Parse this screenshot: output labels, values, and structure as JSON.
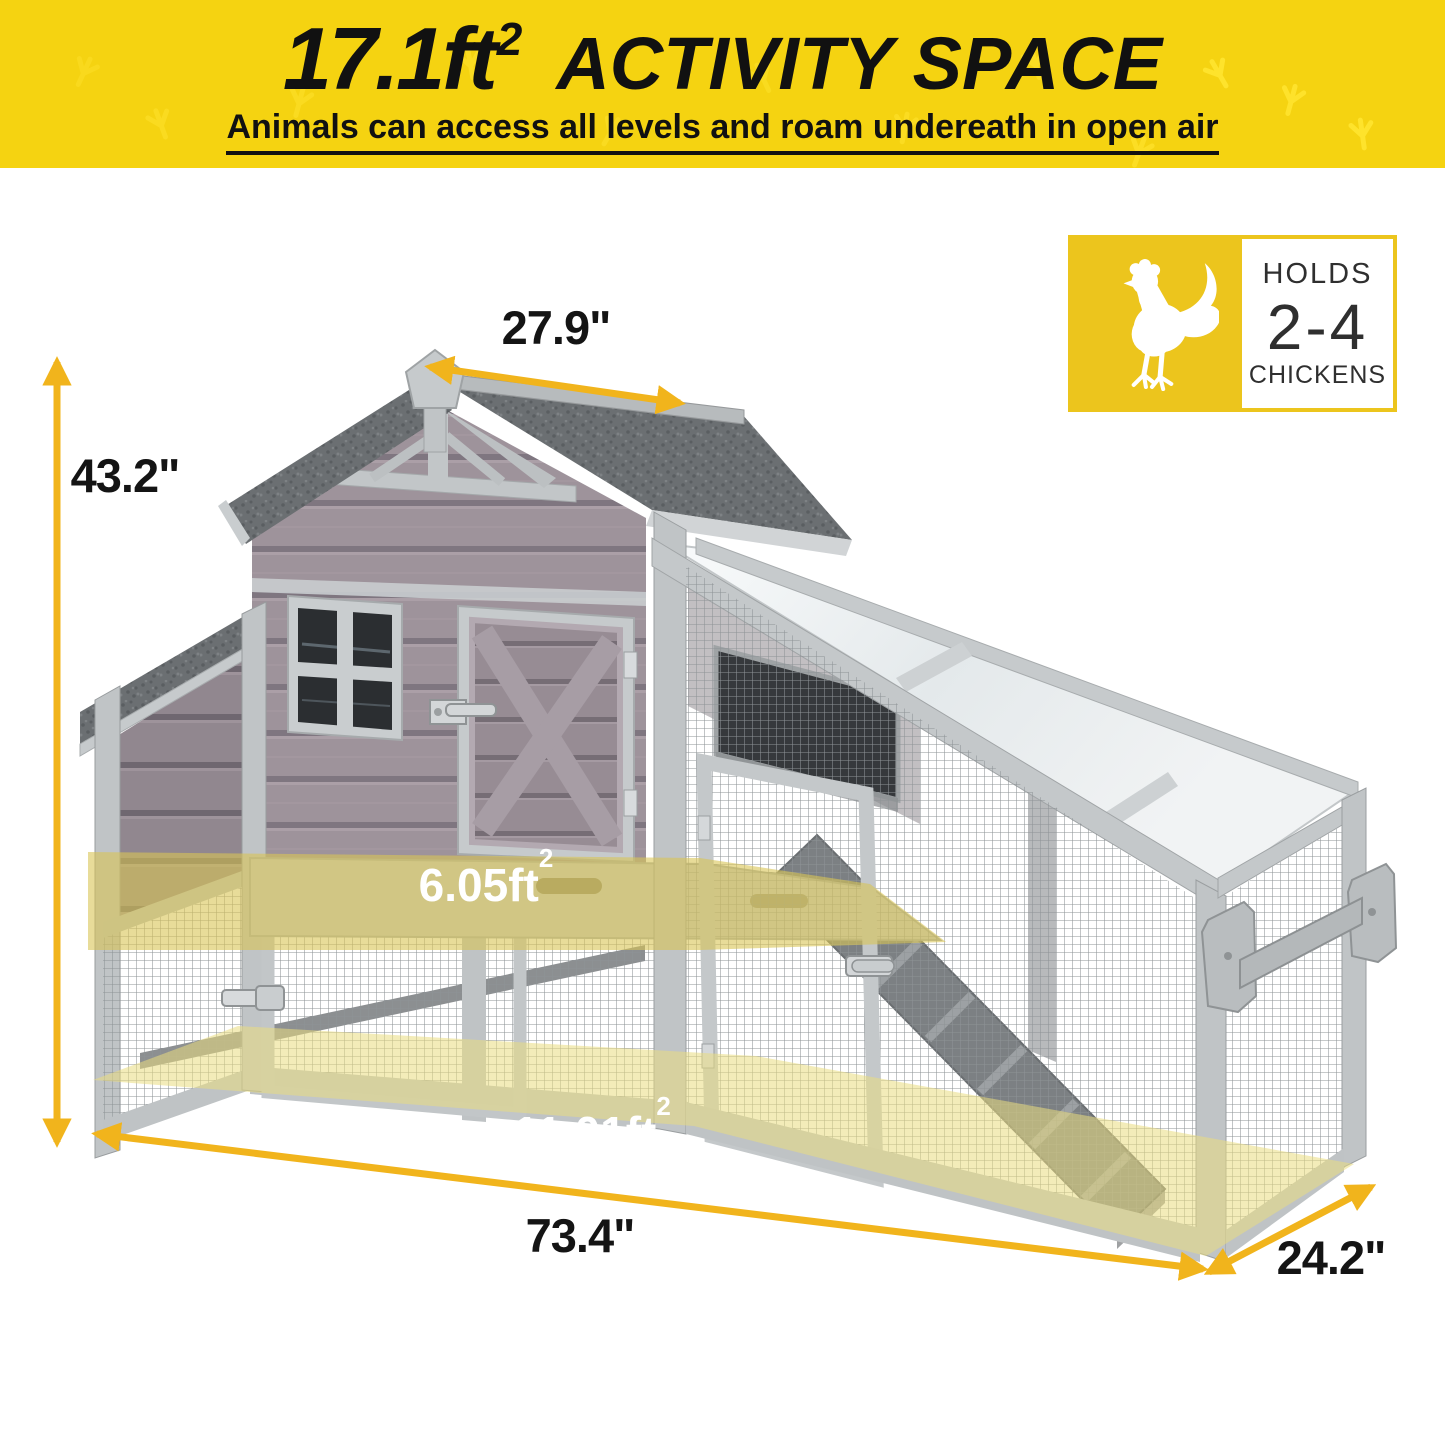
{
  "page": {
    "background": "#FFFFFF"
  },
  "banner": {
    "area_value": "17.1ft",
    "area_sup": "2",
    "area_label": "ACTIVITY SPACE",
    "subtitle": "Animals can access all levels and roam undereath in open air",
    "bg_color": "#F5D311",
    "footprint_color": "#FFE430",
    "text_color": "#111111"
  },
  "badge": {
    "holds_label": "HOLDS",
    "count": "2-4",
    "chickens_label": "CHICKENS",
    "yellow": "#ECC51D",
    "rooster_icon": "rooster-silhouette",
    "text_color": "#2F2F2F"
  },
  "dimensions": {
    "height_label": "43.2\"",
    "roof_width_label": "27.9\"",
    "length_label": "73.4\"",
    "depth_label": "24.2\"",
    "upper_area_value": "6.05ft",
    "upper_area_sup": "2",
    "ground_area_value": "11.01ft",
    "ground_area_sup": "2",
    "arrow_color": "#F1B41C",
    "label_color": "#141414",
    "area_label_color": "#FFFFFF"
  },
  "illustration": {
    "name": "chicken-coop-product-photo",
    "palette": {
      "wood_frame": "#C2C6C8",
      "siding": "#9D929A",
      "shingle_roof": "#6B6F72",
      "clear_roof": "#EFF2F3",
      "mesh": "#8E9396",
      "highlight_yellow": "#D8C455"
    }
  }
}
